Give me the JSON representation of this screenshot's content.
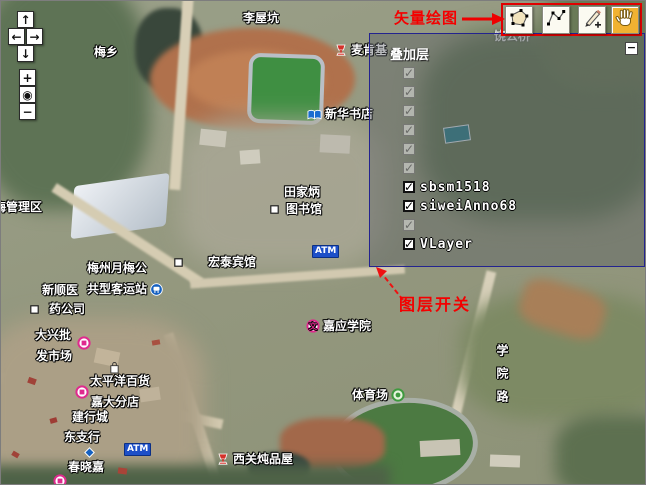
{
  "annotations": {
    "vector_draw_label": "矢量绘图",
    "layer_switch_label": "图层开关"
  },
  "nav_controls": {
    "buttons": [
      {
        "name": "pan-up",
        "glyph": "↑"
      },
      {
        "name": "pan-left",
        "glyph": "←"
      },
      {
        "name": "pan-right",
        "glyph": "→"
      },
      {
        "name": "pan-down",
        "glyph": "↓"
      },
      {
        "name": "zoom-in",
        "glyph": "+"
      },
      {
        "name": "zoom-world",
        "glyph": "◉"
      },
      {
        "name": "zoom-out",
        "glyph": "−"
      }
    ]
  },
  "toolbar": {
    "tools": [
      {
        "name": "draw-polygon-tool",
        "icon": "polygon-icon",
        "active": false
      },
      {
        "name": "draw-line-tool",
        "icon": "polyline-icon",
        "active": false
      },
      {
        "name": "draw-point-tool",
        "icon": "pencil-icon",
        "active": false
      },
      {
        "name": "pan-hand-tool",
        "icon": "hand-icon",
        "active": true
      }
    ],
    "highlight_color": "#e00000",
    "active_color": "#f0b232"
  },
  "layer_panel": {
    "title": "叠加层",
    "minimize_glyph": "−",
    "border_color": "#23238f",
    "layers": [
      {
        "label": "",
        "checked": true,
        "faded": true
      },
      {
        "label": "",
        "checked": true,
        "faded": true
      },
      {
        "label": "",
        "checked": true,
        "faded": true
      },
      {
        "label": "",
        "checked": true,
        "faded": true
      },
      {
        "label": "",
        "checked": true,
        "faded": true
      },
      {
        "label": "",
        "checked": true,
        "faded": true
      },
      {
        "label": "sbsm1518",
        "checked": true,
        "faded": false
      },
      {
        "label": "siweiAnno68",
        "checked": true,
        "faded": false
      },
      {
        "label": "",
        "checked": true,
        "faded": true
      },
      {
        "label": "VLayer",
        "checked": true,
        "faded": false
      }
    ]
  },
  "map_labels": [
    {
      "name": "label-liwukeng",
      "text": "李屋坑",
      "x": 243,
      "y": 12
    },
    {
      "name": "label-meixiang",
      "text": "梅乡",
      "x": 94,
      "y": 46
    },
    {
      "name": "label-maikenji",
      "text": "麦肯基",
      "x": 334,
      "y": 43,
      "icon": "food-icon"
    },
    {
      "name": "label-xinhua-bookstore",
      "text": "新华书店",
      "x": 307,
      "y": 108,
      "icon": "book-icon"
    },
    {
      "name": "label-tianjiabing-line1",
      "text": "田家炳",
      "x": 284,
      "y": 186
    },
    {
      "name": "label-tianjiabing-line2",
      "text": "图书馆",
      "x": 270,
      "y": 203,
      "icon": "marker-square-icon",
      "gap": 4
    },
    {
      "name": "label-hongtai-hotel",
      "text": "宏泰宾馆",
      "x": 174,
      "y": 256,
      "icon": "marker-square-icon",
      "gap": 22
    },
    {
      "name": "label-mei-district",
      "text": "梅管理区",
      "x": -6,
      "y": 201
    },
    {
      "name": "label-bus-station-line1",
      "text": "梅州月梅公",
      "x": 87,
      "y": 262
    },
    {
      "name": "label-bus-station-line2",
      "text": "共型客运站",
      "x": 87,
      "y": 283,
      "icon": "bus-icon",
      "icon_after": true
    },
    {
      "name": "label-pharmacy-line1",
      "text": "新顺医",
      "x": 42,
      "y": 284
    },
    {
      "name": "label-pharmacy-line2",
      "text": "药公司",
      "x": 30,
      "y": 303,
      "icon": "marker-square-icon",
      "gap": 7
    },
    {
      "name": "label-daxing-market-line1",
      "text": "大兴批",
      "x": 35,
      "y": 329
    },
    {
      "name": "label-daxing-market-line2",
      "text": "发市场",
      "x": 36,
      "y": 350
    },
    {
      "name": "daxing-market-poi",
      "text": "",
      "x": 77,
      "y": 336,
      "icon": "shop-icon"
    },
    {
      "name": "shopping-bag-poi",
      "text": "",
      "x": 109,
      "y": 361,
      "icon": "bag-icon"
    },
    {
      "name": "label-pacific-dept-line1",
      "text": "太平洋百货",
      "x": 90,
      "y": 375
    },
    {
      "name": "label-pacific-dept-line2",
      "text": "嘉大分店",
      "x": 91,
      "y": 396
    },
    {
      "name": "pacific-dept-poi",
      "text": "",
      "x": 75,
      "y": 385,
      "icon": "shop-icon"
    },
    {
      "name": "label-ccb-branch-line1",
      "text": "建行城",
      "x": 72,
      "y": 411
    },
    {
      "name": "label-ccb-branch-line2",
      "text": "东支行",
      "x": 64,
      "y": 431
    },
    {
      "name": "blue-diamond-poi",
      "text": "",
      "x": 83,
      "y": 446,
      "icon": "diamond-icon"
    },
    {
      "name": "label-chunxiaojia",
      "text": "春晓嘉",
      "x": 68,
      "y": 461
    },
    {
      "name": "chunxiaojia-poi",
      "text": "",
      "x": 53,
      "y": 474,
      "icon": "shop-icon"
    },
    {
      "name": "label-jiaying-university",
      "text": "嘉应学院",
      "x": 306,
      "y": 319,
      "icon": "school-icon"
    },
    {
      "name": "label-stadium",
      "text": "体育场",
      "x": 352,
      "y": 388,
      "icon": "sport-icon",
      "icon_after": true
    },
    {
      "name": "label-xiguan-restaurant",
      "text": "西关炖品屋",
      "x": 216,
      "y": 452,
      "icon": "food-icon"
    },
    {
      "name": "label-atm-south",
      "text": "ATM",
      "x": 124,
      "y": 443,
      "cls": "atm"
    },
    {
      "name": "label-atm-mid",
      "text": "ATM",
      "x": 312,
      "y": 245,
      "cls": "atm"
    },
    {
      "name": "label-raogong-bridge",
      "text": "饶公桥",
      "x": 494,
      "y": 30,
      "cls": "dim"
    },
    {
      "name": "label-xueyuan-road",
      "text": "学院路",
      "x": 495,
      "y": 344,
      "vertical": true
    }
  ]
}
